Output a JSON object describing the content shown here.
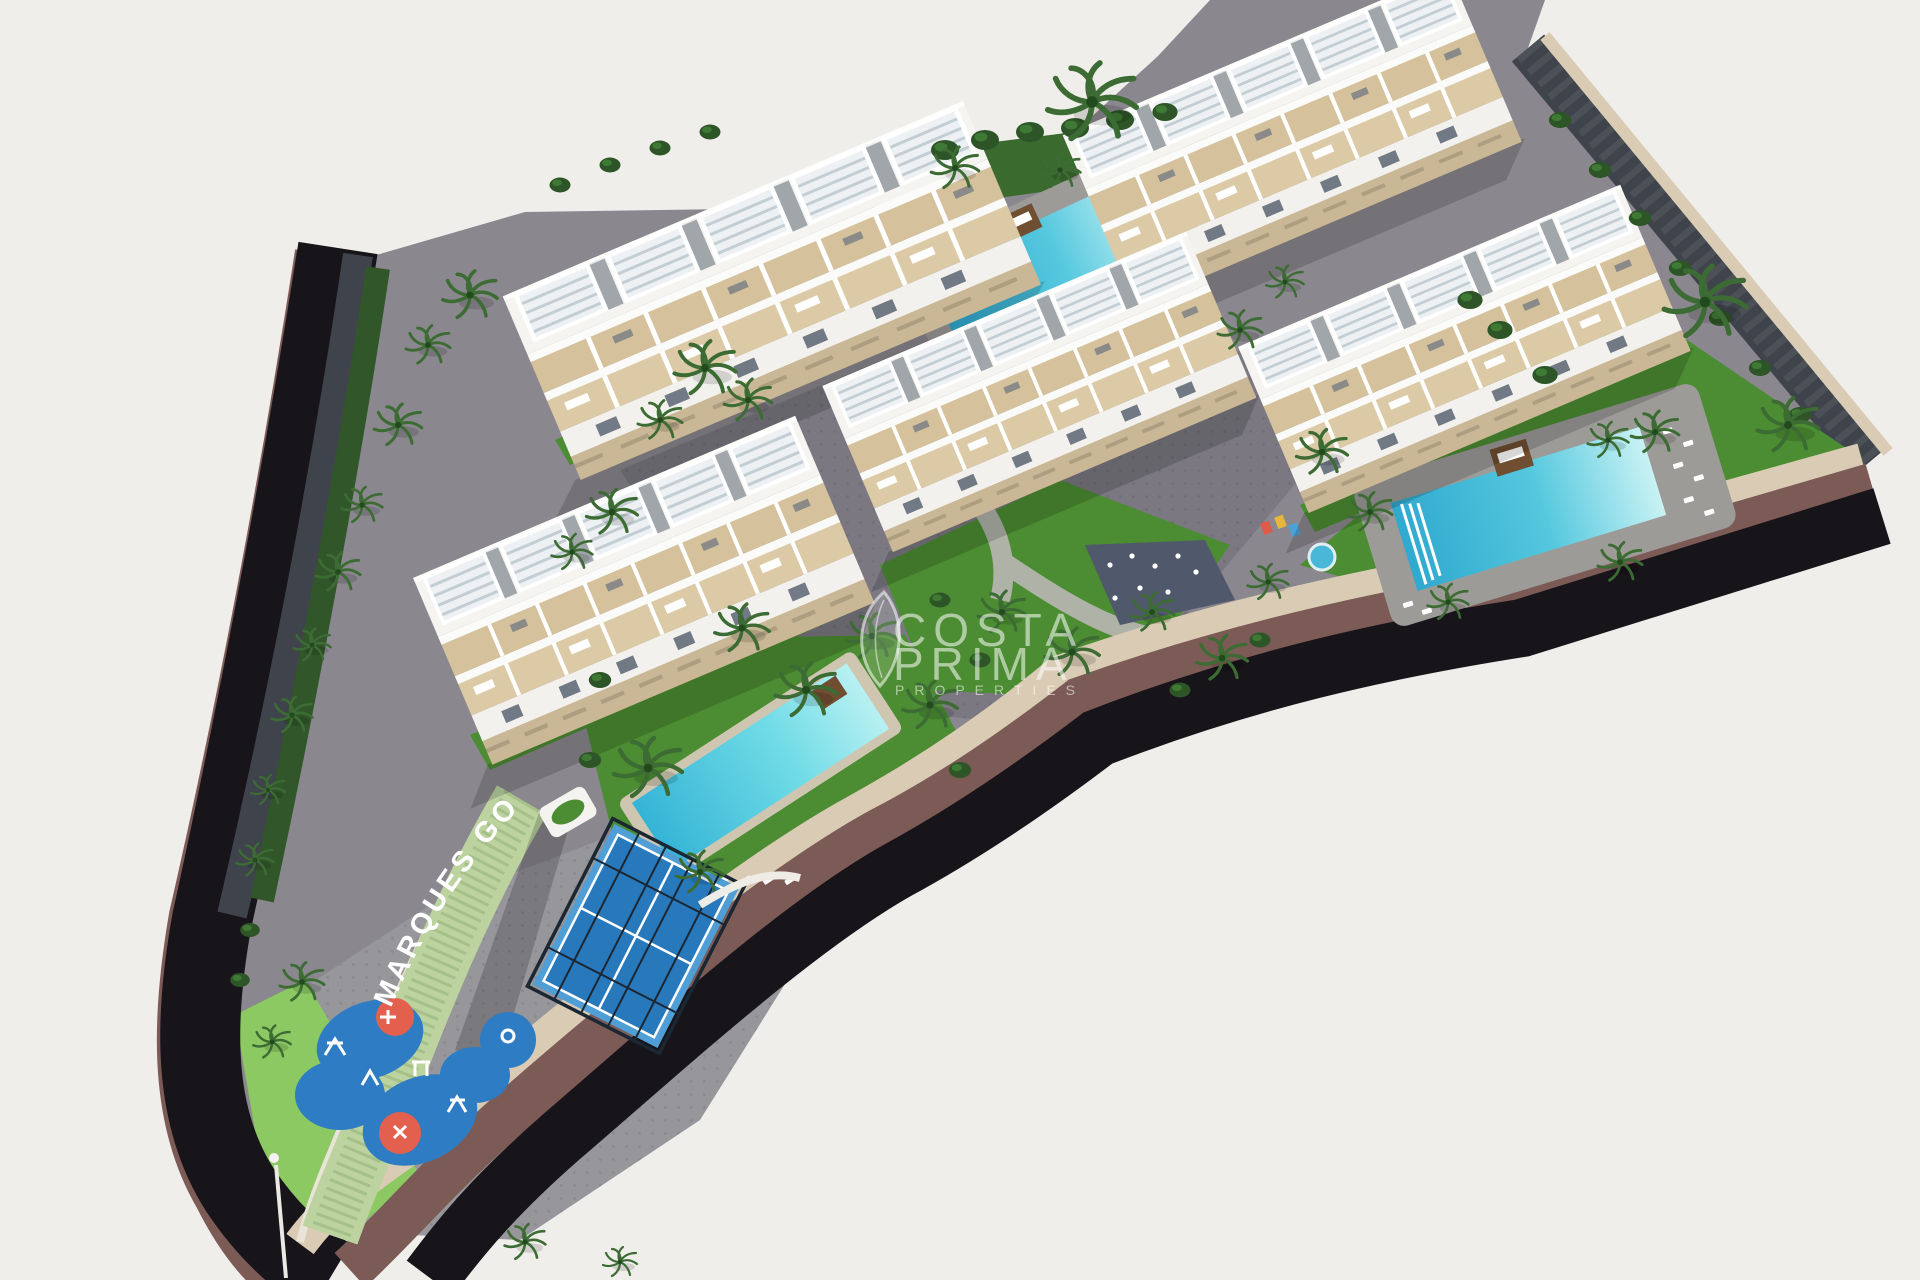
{
  "scene": {
    "kind": "aerial-3d-architectural-render",
    "subject": "Isometric aerial render of a white Mediterranean apartment complex with rooftop pergolas, three swimming pools, a padel court, a children's playground and palm trees, bounded by a dark perimeter road",
    "watermark": {
      "line1": "COSTA",
      "line2": "PRIMA",
      "line3": "PROPERTIES"
    },
    "ground_label": {
      "text": "MARQUES GOLF"
    },
    "features": {
      "buildings_count": 5,
      "pools_count": 3,
      "padel_courts_count": 1,
      "playgrounds_count": 1
    }
  },
  "palette": {
    "background": "#f0eeeb",
    "road": "#17141a",
    "wall_maroon": "#7c5a55",
    "wall_stone": "#d9cbb4",
    "wall_dark_stone": "#3f434b",
    "paving": "#8a878e",
    "paving_light": "#97969a",
    "paving_dark": "#7b7881",
    "grass": "#4c8c32",
    "grass_light": "#8cc963",
    "hedge_sage": "#bcd3a0",
    "bush_dark": "#2e5527",
    "pool_deep": "#2fa9cf",
    "pool_shallow": "#c9f2f4",
    "pool_deck": "#9d9b98",
    "building_white": "#f5f4f1",
    "terrace_beige": "#d9c7a2",
    "stone_base": "#c9b795",
    "pergola_slat": "#c2cdd4",
    "court_blue": "#4f9fd6",
    "court_blue_dark": "#2878bc",
    "fence_dark": "#1b2733",
    "playground_blue": "#2e7cc3",
    "playground_orange": "#e4604e",
    "palm_green": "#3c6b33",
    "zen_patch": "#50596b",
    "wood_brown": "#6f4e31",
    "lounger_white": "#ffffff"
  }
}
